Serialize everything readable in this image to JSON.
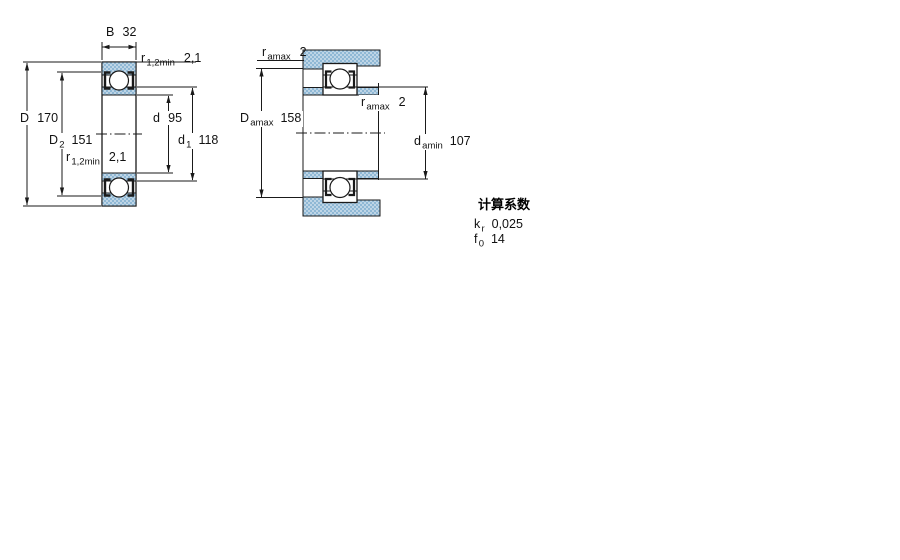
{
  "figure_left": {
    "description": "bearing-cross-section-view",
    "labels_present": [
      "B 32",
      "r 1,2min 2,1",
      "D 170",
      "D2 151",
      "d 95",
      "d1 118",
      "r 1,2min 2,1"
    ]
  },
  "figure_right": {
    "description": "bearing-abutment-fit-view",
    "labels_present": [
      "r amax 2",
      "D amax 158",
      "r amax 2",
      "d amin 107"
    ]
  },
  "labels": {
    "B": {
      "sym": "B",
      "sub": "",
      "value": "32"
    },
    "r12_top": {
      "sym": "r",
      "sub": "1,2min",
      "value": "2,1"
    },
    "D": {
      "sym": "D",
      "sub": "",
      "value": "170"
    },
    "D2": {
      "sym": "D",
      "sub": "2",
      "value": "151"
    },
    "d": {
      "sym": "d",
      "sub": "",
      "value": "95"
    },
    "d1": {
      "sym": "d",
      "sub": "1",
      "value": "118"
    },
    "r12_bottom": {
      "sym": "r",
      "sub": "1,2min",
      "value": "2,1"
    },
    "r_amax_top": {
      "sym": "r",
      "sub": "amax",
      "value": "2"
    },
    "D_amax": {
      "sym": "D",
      "sub": "amax",
      "value": "158"
    },
    "r_amax_mid": {
      "sym": "r",
      "sub": "amax",
      "value": "2"
    },
    "d_amin": {
      "sym": "d",
      "sub": "amin",
      "value": "107"
    }
  },
  "calculation_factors": {
    "title": "计算系数",
    "rows": [
      {
        "sym": "k",
        "sub": "r",
        "value": "0,025"
      },
      {
        "sym": "f",
        "sub": "0",
        "value": "14"
      }
    ]
  },
  "colors": {
    "section_fill_base": "#bed5e6",
    "section_fill_dot": "#8fb8d5",
    "line": "#1a1a1a",
    "background": "#ffffff"
  }
}
